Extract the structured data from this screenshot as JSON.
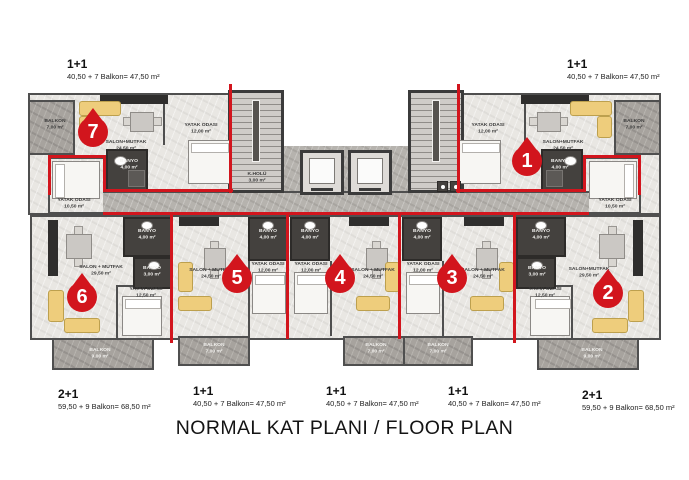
{
  "title": "NORMAL KAT PLANI / FLOOR PLAN",
  "units": {
    "u7": {
      "number": "7",
      "type": "1+1",
      "area_label": "40,50 + 7 Balkon= 47,50 m²"
    },
    "u1": {
      "number": "1",
      "type": "1+1",
      "area_label": "40,50 + 7 Balkon= 47,50 m²"
    },
    "u6": {
      "number": "6",
      "type": "2+1",
      "area_label": "59,50 + 9 Balkon= 68,50 m²"
    },
    "u5": {
      "number": "5",
      "type": "1+1",
      "area_label": "40,50 + 7 Balkon= 47,50 m²"
    },
    "u4": {
      "number": "4",
      "type": "1+1",
      "area_label": "40,50 + 7 Balkon= 47,50 m²"
    },
    "u3": {
      "number": "3",
      "type": "1+1",
      "area_label": "40,50 + 7 Balkon= 47,50 m²"
    },
    "u2": {
      "number": "2",
      "type": "2+1",
      "area_label": "59,50 + 9 Balkon= 68,50 m²"
    }
  },
  "rooms": {
    "u7_balkon": {
      "name": "BALKON",
      "area": "7,00 m²"
    },
    "u7_salon": {
      "name": "SALON+MUTFAK",
      "area": "24,50 m²"
    },
    "u7_banyo": {
      "name": "BANYO",
      "area": "4,00 m²"
    },
    "u7_yatak": {
      "name": "YATAK ODASI",
      "area": "12,00 m²"
    },
    "u1_balkon": {
      "name": "BALKON",
      "area": "7,00 m²"
    },
    "u1_salon": {
      "name": "SALON+MUTFAK",
      "area": "24,50 m²"
    },
    "u1_banyo": {
      "name": "BANYO",
      "area": "4,00 m²"
    },
    "u1_yatak": {
      "name": "YATAK ODASI",
      "area": "12,00 m²"
    },
    "u6_yatak_small": {
      "name": "YATAK ODASI",
      "area": "10,50 m²"
    },
    "u6_banyo_big": {
      "name": "BANYO",
      "area": "4,00 m²"
    },
    "u6_banyo_small": {
      "name": "BANYO",
      "area": "3,00 m²"
    },
    "u6_yatak": {
      "name": "YATAK ODASI",
      "area": "12,50 m²"
    },
    "u6_salon": {
      "name": "SALON + MUTFAK",
      "area": "29,50 m²"
    },
    "u6_balkon": {
      "name": "BALKON",
      "area": "9,00 m²"
    },
    "u5_banyo": {
      "name": "BANYO",
      "area": "4,00 m²"
    },
    "u5_yatak": {
      "name": "YATAK ODASI",
      "area": "12,00 m²"
    },
    "u5_salon": {
      "name": "SALON + MUTFAK",
      "area": "24,50 m²"
    },
    "u5_balkon": {
      "name": "BALKON",
      "area": "7,00 m²"
    },
    "u4_banyo": {
      "name": "BANYO",
      "area": "4,00 m²"
    },
    "u4_yatak": {
      "name": "YATAK ODASI",
      "area": "12,00 m²"
    },
    "u4_salon": {
      "name": "SALON + MUTFAK",
      "area": "24,50 m²"
    },
    "u4_balkon": {
      "name": "BALKON",
      "area": "7,00 m²"
    },
    "u3_banyo": {
      "name": "BANYO",
      "area": "4,00 m²"
    },
    "u3_yatak": {
      "name": "YATAK ODASI",
      "area": "12,00 m²"
    },
    "u3_salon": {
      "name": "SALON + MUTFAK",
      "area": "24,50 m²"
    },
    "u3_balkon": {
      "name": "BALKON",
      "area": "7,00 m²"
    },
    "u2_yatak_small": {
      "name": "YATAK ODASI",
      "area": "10,50 m²"
    },
    "u2_banyo_big": {
      "name": "BANYO",
      "area": "4,00 m²"
    },
    "u2_banyo_small": {
      "name": "BANYO",
      "area": "3,00 m²"
    },
    "u2_yatak": {
      "name": "YATAK ODASI",
      "area": "12,50 m²"
    },
    "u2_salon": {
      "name": "SALON+MUTFAK",
      "area": "29,50 m²"
    },
    "u2_balkon": {
      "name": "BALKON",
      "area": "9,00 m²"
    },
    "core_hall": {
      "name": "K.HOLÜ",
      "area": "3,00 m²"
    }
  },
  "colors": {
    "accent_red": "#d2151d",
    "wall": "#4f4f4f"
  }
}
